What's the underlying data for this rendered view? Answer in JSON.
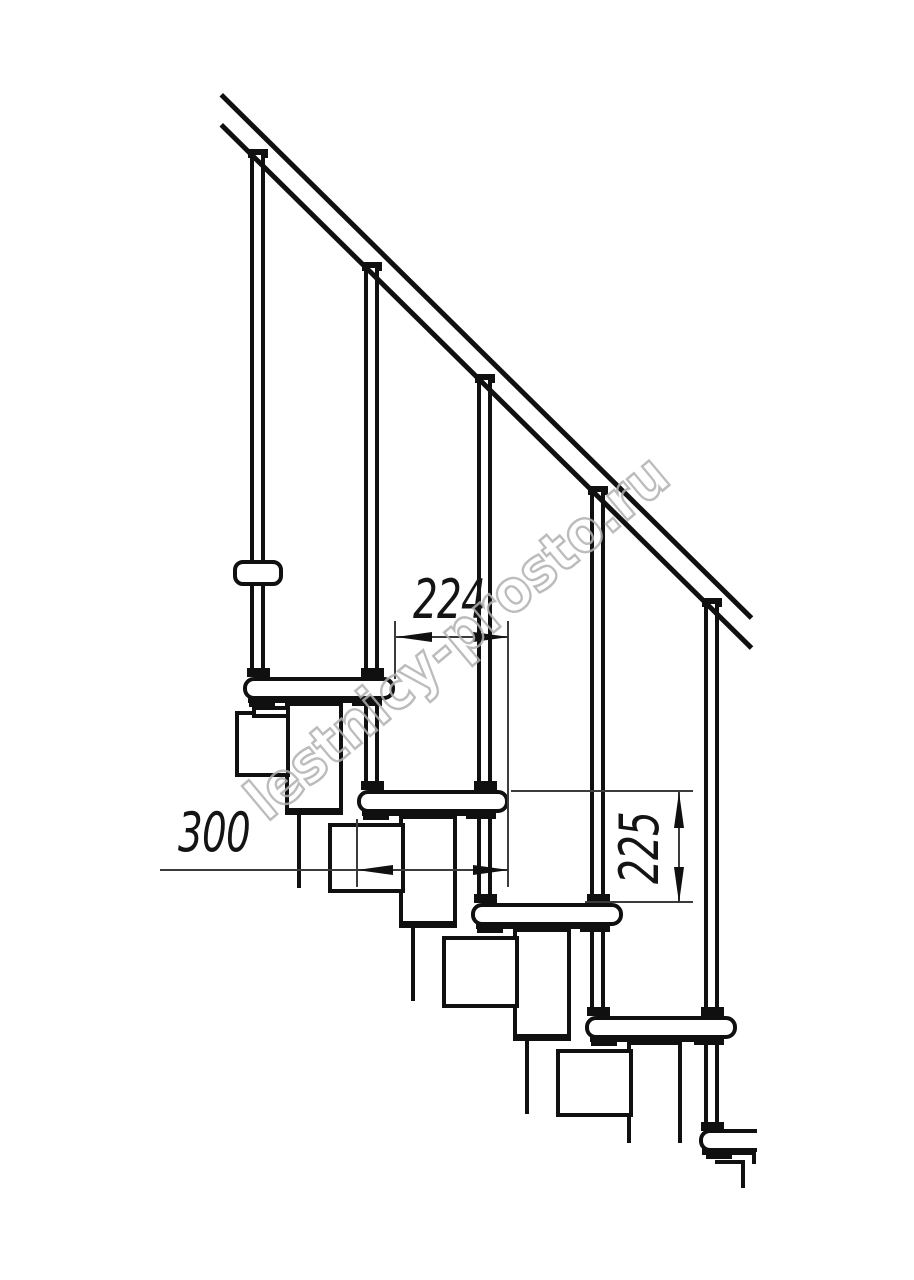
{
  "title": "Modular staircase side elevation drawing",
  "dimensions": {
    "step_run": {
      "value": "224"
    },
    "step_length": {
      "value": "300"
    },
    "step_rise": {
      "value": "225"
    }
  },
  "watermark": {
    "text": "lestnicy-prosto.ru"
  },
  "colors": {
    "line": "#101010",
    "dimension_line": "#3c3c3c",
    "watermark_stroke": "#b0b0b0",
    "background": "#ffffff"
  }
}
